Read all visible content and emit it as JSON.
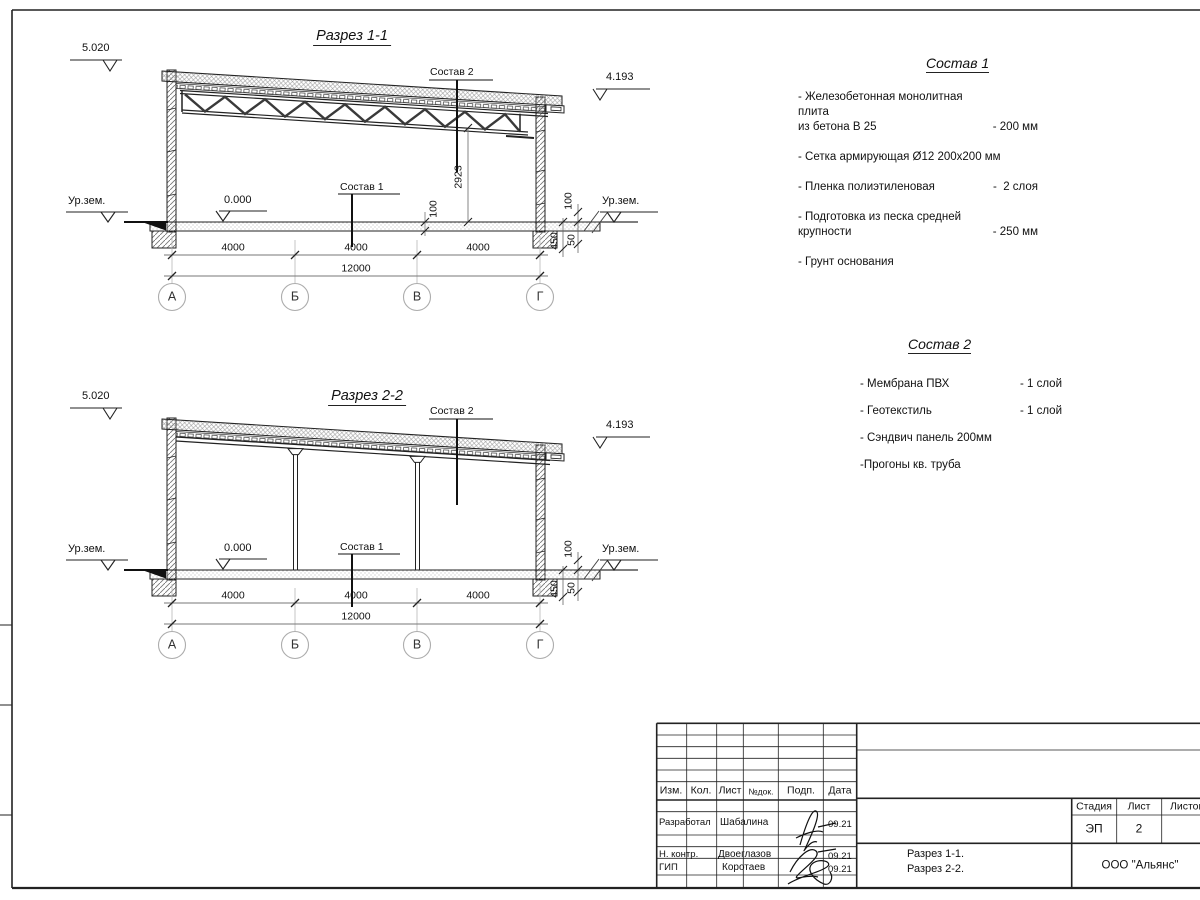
{
  "sheet": {
    "section1": {
      "title": "Разрез 1-1",
      "elev_top": "5.020",
      "elev_roof": "4.193",
      "zero": "0.000",
      "ground_label": "Ур.зем.",
      "leader_roof": "Состав 2",
      "leader_floor": "Состав 1",
      "dim_height": "2923",
      "dim_floor": "100",
      "dim_right": "100",
      "dim_found": "450",
      "dim_sand": "50",
      "bays": [
        "4000",
        "4000",
        "4000"
      ],
      "total": "12000",
      "axes": [
        "А",
        "Б",
        "В",
        "Г"
      ]
    },
    "section2": {
      "title": "Разрез 2-2",
      "elev_top": "5.020",
      "elev_roof": "4.193",
      "zero": "0.000",
      "ground_label": "Ур.зем.",
      "leader_roof": "Состав 2",
      "leader_floor": "Состав 1",
      "dim_right": "100",
      "dim_found": "450",
      "dim_sand": "50",
      "bays": [
        "4000",
        "4000",
        "4000"
      ],
      "total": "12000",
      "axes": [
        "А",
        "Б",
        "В",
        "Г"
      ]
    },
    "spec1": {
      "title": "Состав 1",
      "items": [
        {
          "name": "- Железобетонная  монолитная плита\n  из бетона В 25",
          "value": "- 200 мм"
        },
        {
          "name": "- Сетка армирующая Ø12 200х200 мм",
          "value": ""
        },
        {
          "name": "- Пленка полиэтиленовая",
          "value": "-  2 слоя"
        },
        {
          "name": "- Подготовка из песка средней\n  крупности",
          "value": "- 250 мм"
        },
        {
          "name": "- Грунт основания",
          "value": ""
        }
      ]
    },
    "spec2": {
      "title": "Состав 2",
      "items": [
        {
          "name": "- Мембрана ПВХ",
          "value": "- 1 слой"
        },
        {
          "name": "- Геотекстиль",
          "value": "- 1 слой"
        },
        {
          "name": "- Сэндвич панель 200мм",
          "value": ""
        },
        {
          "name": "-Прогоны кв. труба",
          "value": ""
        }
      ]
    },
    "titleblock": {
      "cols": [
        "Изм.",
        "Кол.",
        "Лист",
        "№док.",
        "Подп.",
        "Дата"
      ],
      "rows": [
        {
          "role": "Разработал",
          "name": "Шабалина",
          "date": "09.21"
        },
        {
          "role": "Н. контр.",
          "name": "Двоеглазов",
          "date": "09.21"
        },
        {
          "role": "ГИП",
          "name": "Коротаев",
          "date": "09.21"
        }
      ],
      "stage_label": "Стадия",
      "sheet_label": "Лист",
      "sheets_label": "Листов",
      "stage": "ЭП",
      "sheet_no": "2",
      "doc_title": "Разрез 1-1.\nРазрез 2-2.",
      "company": "ООО \"Альянс\""
    }
  }
}
